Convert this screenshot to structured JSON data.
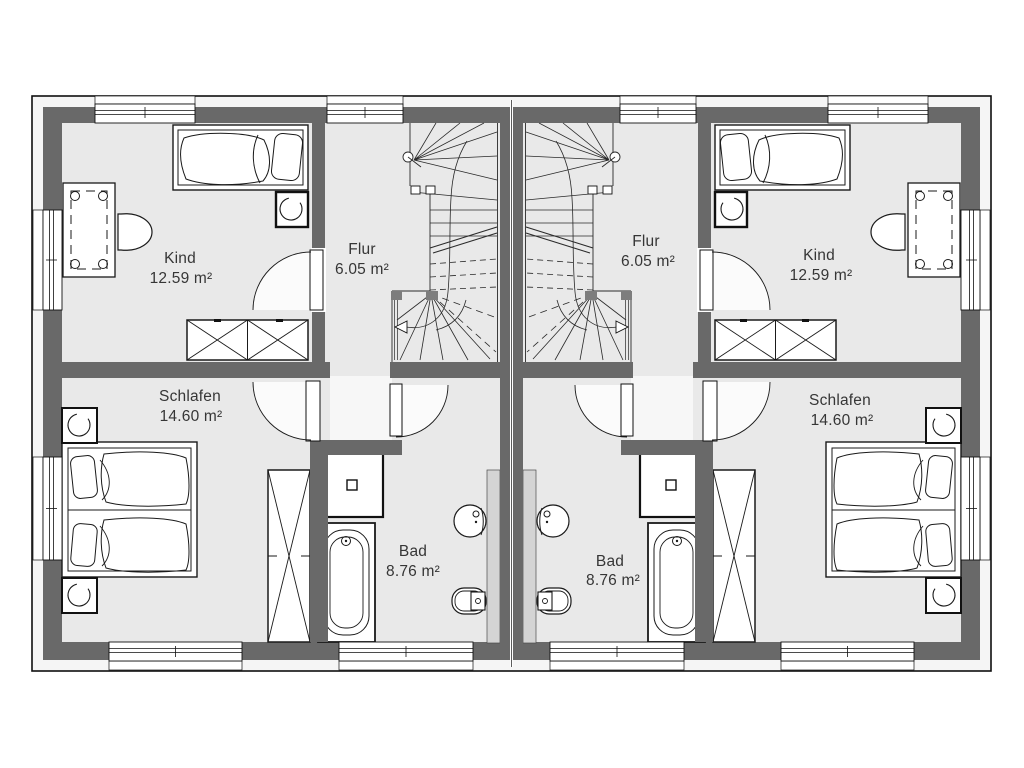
{
  "plan": {
    "type": "residential floor plan, semi-detached duplex upper floor",
    "colors": {
      "wall": "#696969",
      "floor": "#e9e9e9",
      "facade_strip": "#f5f5f5",
      "installation_wall": "#d4d4d4",
      "line": "#1a1a1a",
      "page": "#ffffff"
    },
    "units": [
      {
        "id": "left",
        "rooms": {
          "kind": {
            "name": "Kind",
            "area": "12.59 m²"
          },
          "flur": {
            "name": "Flur",
            "area": "6.05 m²"
          },
          "schlafen": {
            "name": "Schlafen",
            "area": "14.60 m²"
          },
          "bad": {
            "name": "Bad",
            "area": "8.76 m²"
          }
        }
      },
      {
        "id": "right",
        "rooms": {
          "kind": {
            "name": "Kind",
            "area": "12.59 m²"
          },
          "flur": {
            "name": "Flur",
            "area": "6.05 m²"
          },
          "schlafen": {
            "name": "Schlafen",
            "area": "14.60 m²"
          },
          "bad": {
            "name": "Bad",
            "area": "8.76 m²"
          }
        }
      }
    ]
  }
}
